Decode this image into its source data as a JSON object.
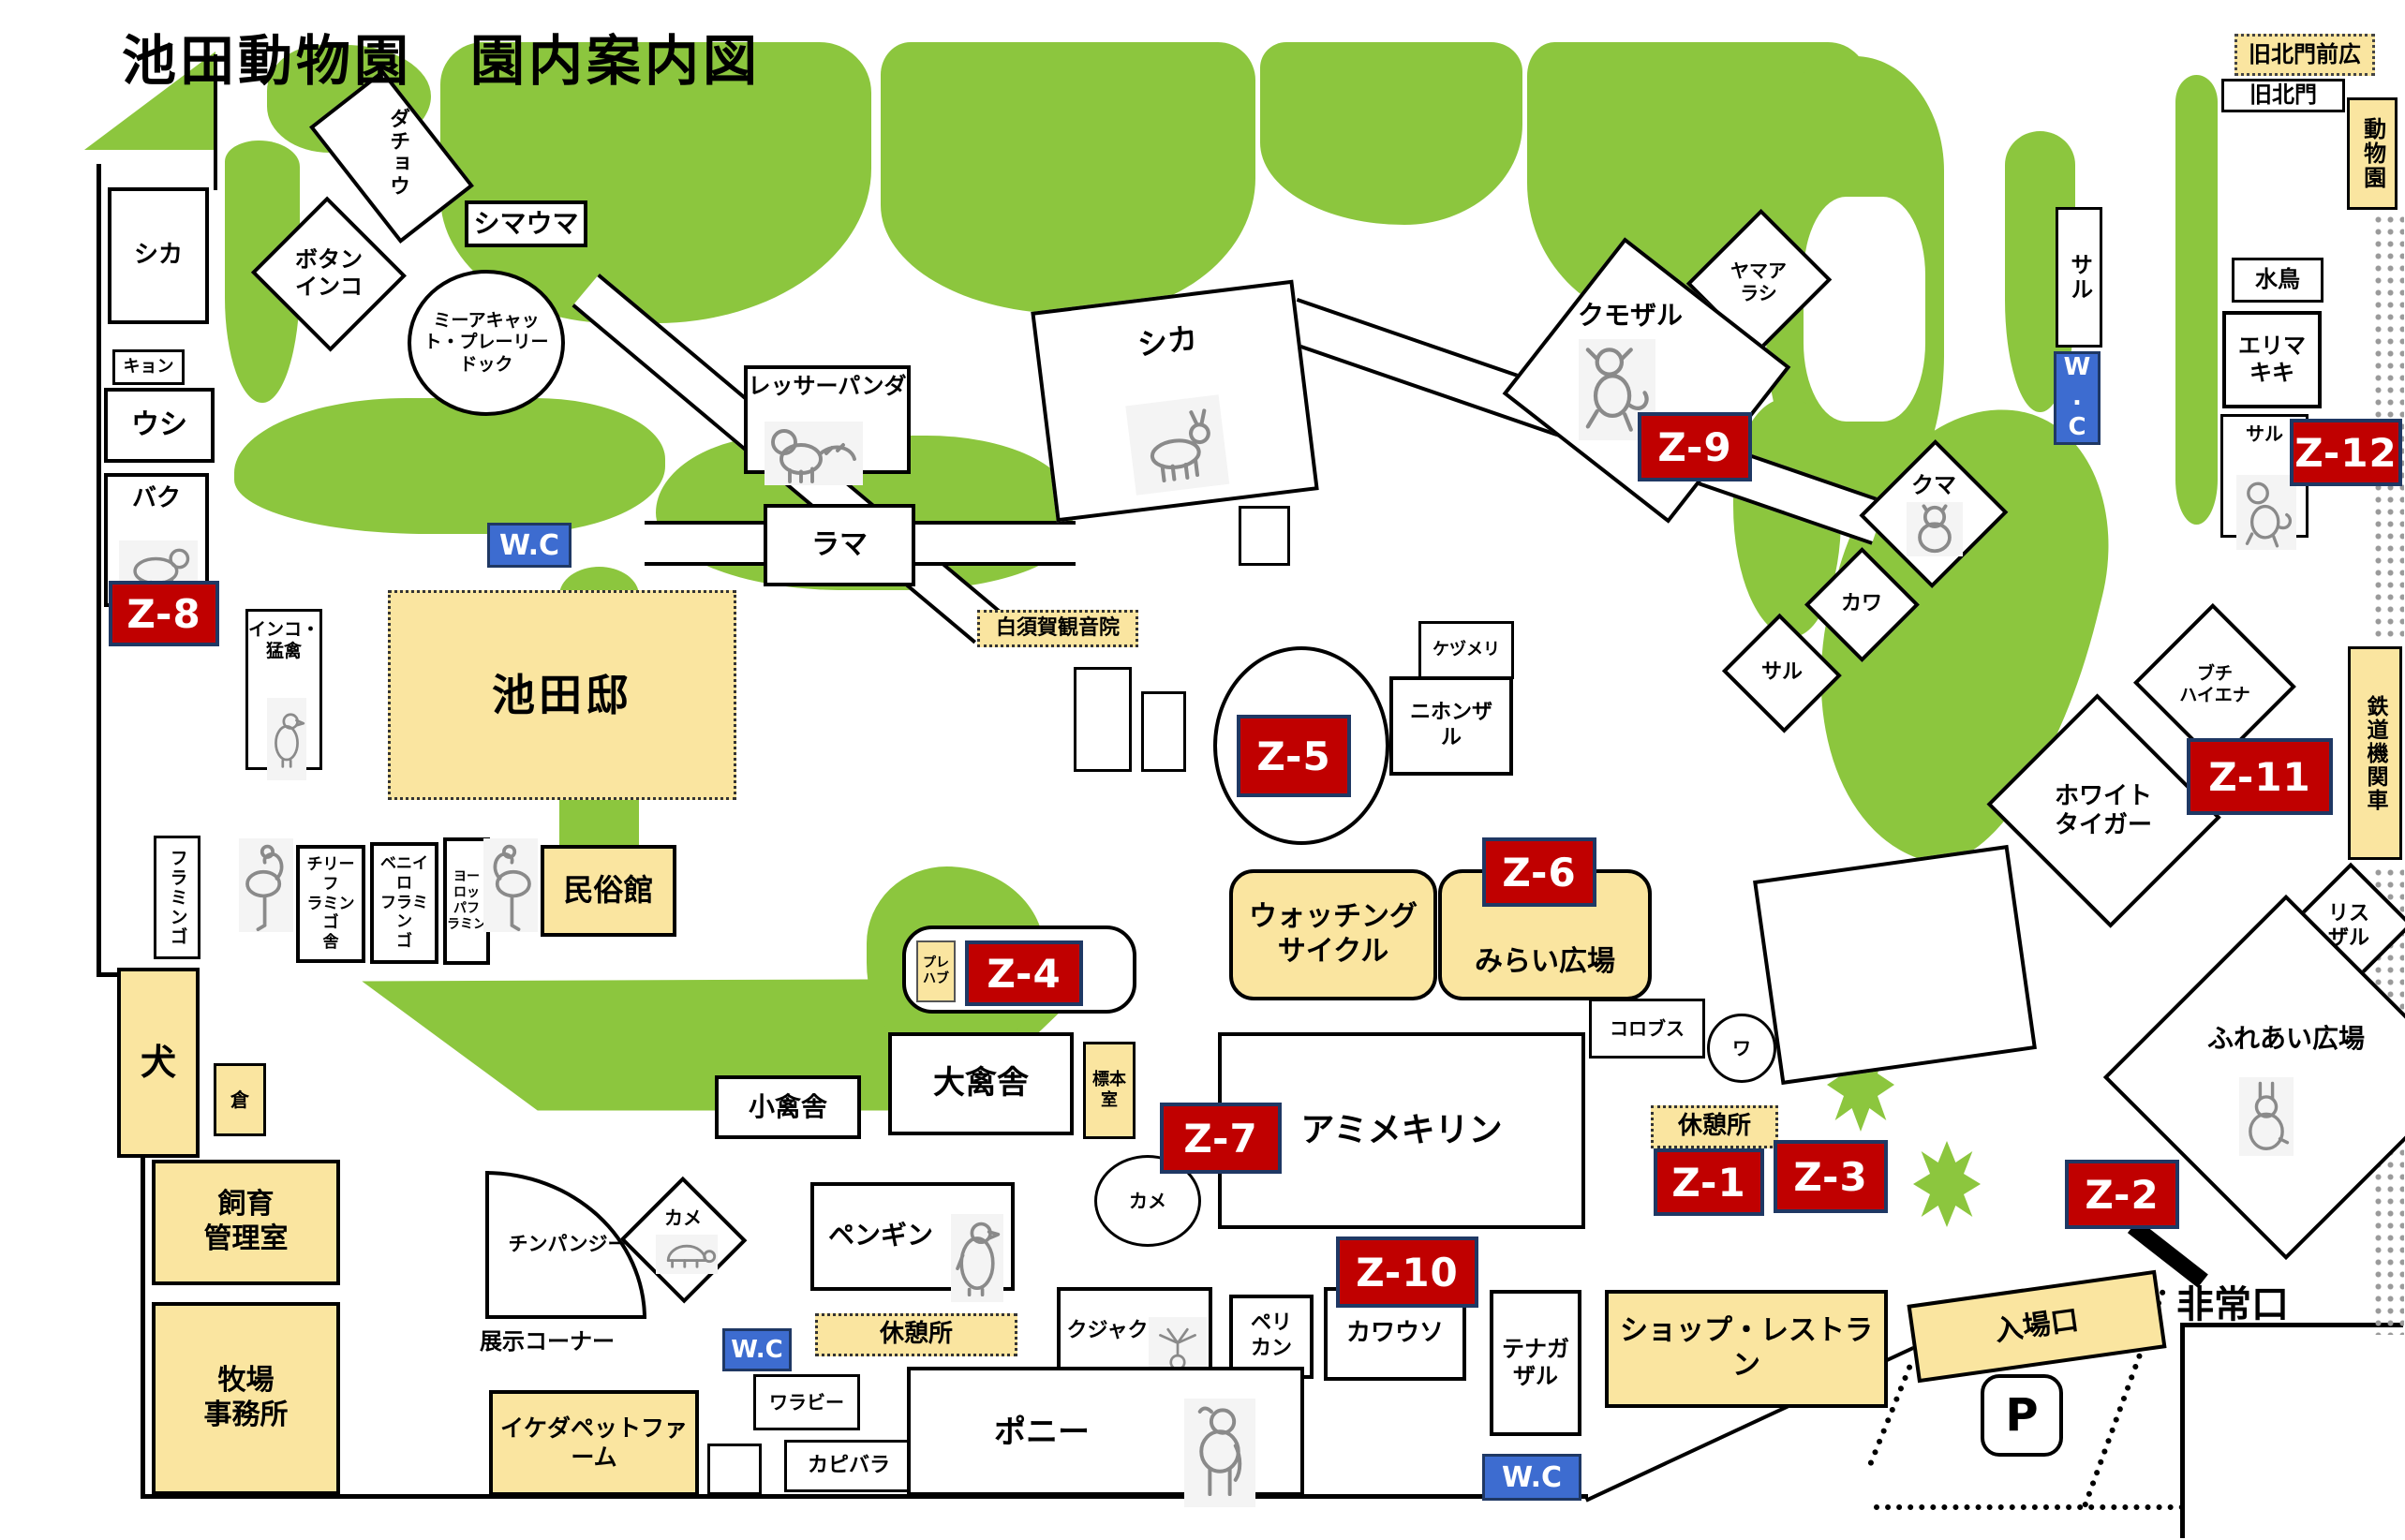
{
  "title": "池田動物園　園内案内図",
  "colors": {
    "lawn_green": "#8CC63E",
    "building_yellow": "#FAE5A0",
    "zone_red": "#C00000",
    "wc_blue": "#3D6CD0"
  },
  "labels": {
    "wc": "W.C",
    "kyu_kitamon_hiroba": "旧北門前広",
    "kyu_kitamon": "旧北門",
    "dobutsuen": "動物園",
    "shika": "シカ",
    "dacho": "ダチョウ",
    "botan_inko": "ボタン\nインコ",
    "shimauma": "シマウマ",
    "meerkat": "ミーアキャッ\nト・プレーリー\nドック",
    "kyon": "キョン",
    "ushi": "ウシ",
    "baku": "バク",
    "inko_mokin": "インコ・\n猛禽",
    "ikeda_tei": "池田邸",
    "lesser_panda": "レッサーパンダ",
    "llama": "ラマ",
    "shika_center": "シカ",
    "shirasuga": "白須賀観音院",
    "kezumeri": "ケヅメリ",
    "nihonzaru": "ニホンザ\nル",
    "yamaarashi": "ヤマア\nラシ",
    "kumozaru": "クモザル",
    "saru": "サル",
    "kuma": "クマ",
    "kawa": "カワ",
    "mizudori": "水鳥",
    "erimakiki": "エリマ\nキキ",
    "buchi_hyena": "ブチ\nハイエナ",
    "white_tiger": "ホワイト\nタイガー",
    "risuzaru": "リス\nザル",
    "fureai": "ふれあい広場",
    "tetsudo": "鉄道機関車",
    "watching_cycle": "ウォッチング\nサイクル",
    "mirai": "みらい広場",
    "colobus": "コロブス",
    "wa": "ワ",
    "kyukeijo": "休憩所",
    "amime_kirin": "アミメキリン",
    "kame": "カメ",
    "prefab": "プレ\nハブ",
    "daikinsha": "大禽舎",
    "hyohon": "標本\n室",
    "shokinsha": "小禽舎",
    "penguin": "ペンギン",
    "wallaby": "ワラビー",
    "capybara": "カピバラ",
    "chimp": "チンパンジー",
    "tenji_corner": "展示コーナー",
    "petfarm": "イケダペットファーム",
    "shiiku": "飼育\n管理室",
    "bokujo": "牧場\n事務所",
    "inu": "犬",
    "kura": "倉",
    "flamingo": "フラミンゴ",
    "chile_flamingo": "チリーフ\nラミンゴ\n舎",
    "beniiro_flamingo": "ベニイロ\nフラミン\nゴ",
    "europe_flamingo": "ヨー\nロッ\nパフ\nラミン",
    "minzokukan": "民俗館",
    "kujaku": "クジャク",
    "pelican": "ペリ\nカン",
    "kawauso": "カワウソ",
    "tenagazaru": "テナガ\nザル",
    "pony": "ポニー",
    "shop": "ショップ・レストラン",
    "nyujoguchi": "入場口",
    "parking": "P",
    "hijoguchi": "非常口"
  },
  "zones": {
    "z1": "Z-1",
    "z2": "Z-2",
    "z3": "Z-3",
    "z4": "Z-4",
    "z5": "Z-5",
    "z6": "Z-6",
    "z7": "Z-7",
    "z8": "Z-8",
    "z9": "Z-9",
    "z10": "Z-10",
    "z11": "Z-11",
    "z12": "Z-12"
  }
}
